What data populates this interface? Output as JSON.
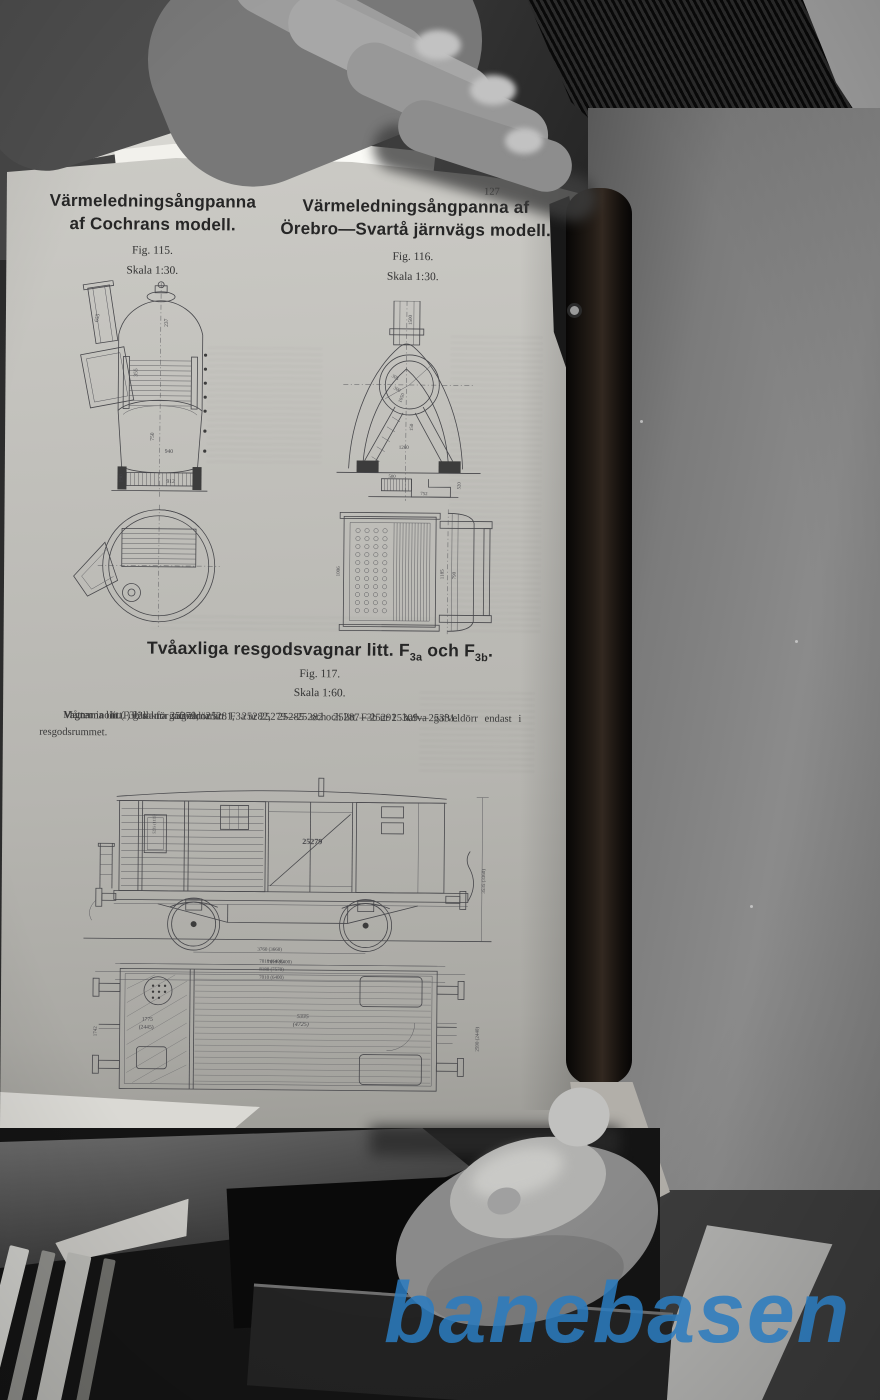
{
  "photo": {
    "watermark_text": "banebasen",
    "watermark_color": "#2b7cc0"
  },
  "page": {
    "number": "127",
    "fig115": {
      "title1": "Värmeledningsångpanna",
      "title2": "af Cochrans modell.",
      "caption": "Fig. 115.",
      "scale": "Skala 1:30.",
      "dims": {
        "chimney": "655",
        "top": "237",
        "neck": "355",
        "mid": "750",
        "width": "940",
        "base": "912",
        "grate": "190"
      }
    },
    "fig116": {
      "title1": "Värmeledningsångpanna af",
      "title2": "Örebro—Svartå järnvägs modell.",
      "caption": "Fig. 116.",
      "scale": "Skala 1:30.",
      "dims": {
        "chimney": "1500",
        "r1": "305",
        "r2": "300",
        "r3": "1050",
        "mid": "150",
        "width": "1260",
        "grate": "500",
        "base": "752",
        "side": "520"
      },
      "dims2": {
        "h1": "1006",
        "h2": "1185",
        "h3": "790"
      }
    },
    "fig117": {
      "title_prefix": "Tvåaxliga resgodsvagnar litt. F",
      "title_sub1": "3a",
      "title_mid": " och F",
      "title_sub2": "3b",
      "title_end": ".",
      "caption": "Fig. 117.",
      "scale": "Skala 1:60.",
      "para1": "Vagnarna litt. F3a nr 25279, 25281, 25282, 25285 och 25287—25291 hafva gafveldörr endast i resgodsrummet.",
      "para2": "Vagnarna litt. F3b sakna gafveldörrar.",
      "para3": "Måtten inom (  ) gälla för vagnarna litt. F3a nr 25279—25282 och litt. F3b nr 25309—25331.",
      "wagon_number": "25279",
      "plate": "5235 (1135)",
      "dim_axle": "3760 (3660)",
      "dim_body": "7010 (6400)",
      "dim_buffer": "8180 (7570)",
      "dim_total": "7010 (6400)",
      "dim_height": "3535 (3360)",
      "plan_top": "7010 (6400)",
      "plan_center1": "5335",
      "plan_center2": "(4725)",
      "plan_left1": "1775",
      "plan_left2": "(2445)",
      "plan_left_v": "1742",
      "plan_right_v": "2590 (2440)"
    }
  }
}
